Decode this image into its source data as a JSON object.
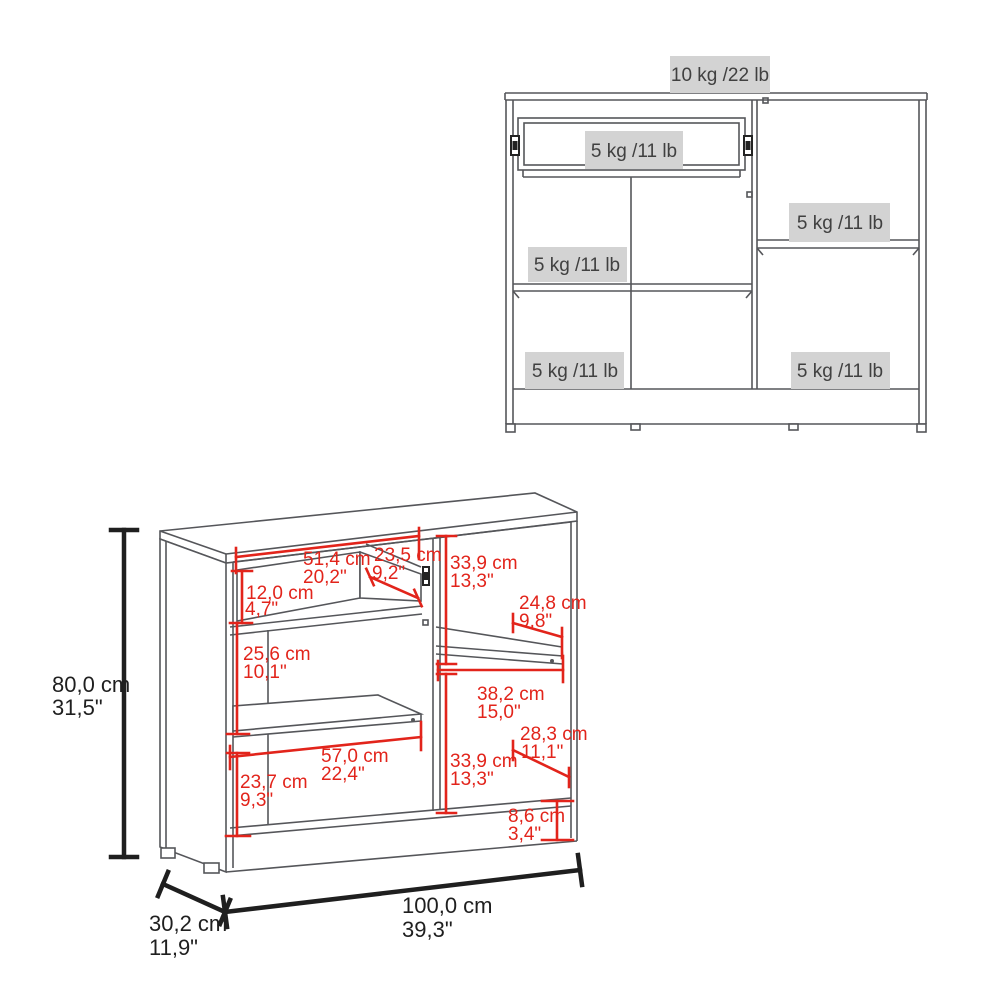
{
  "front_view": {
    "weight_labels": {
      "top": "10 kg /22 lb",
      "drawer": "5 kg /11 lb",
      "left_shelf": "5 kg /11 lb",
      "right_shelf": "5 kg /11 lb",
      "bottom_left": "5 kg /11 lb",
      "bottom_right": "5 kg /11 lb"
    }
  },
  "dimension_view": {
    "height": {
      "cm": "80,0 cm",
      "in": "31,5\""
    },
    "width": {
      "cm": "100,0 cm",
      "in": "39,3\""
    },
    "depth": {
      "cm": "30,2 cm",
      "in": "11,9\""
    },
    "drawer_width": {
      "cm": "51,4 cm",
      "in": "20,2\""
    },
    "drawer_depth": {
      "cm": "23,5 cm",
      "in": "9,2\""
    },
    "drawer_height": {
      "cm": "12,0 cm",
      "in": "4,7\""
    },
    "left_middle_height": {
      "cm": "25,6 cm",
      "in": "10,1\""
    },
    "right_top_height": {
      "cm": "33,9 cm",
      "in": "13,3\""
    },
    "right_shelf_depth": {
      "cm": "24,8 cm",
      "in": "9,8\""
    },
    "right_inner_width": {
      "cm": "38,2 cm",
      "in": "15,0\""
    },
    "left_bottom_width": {
      "cm": "57,0 cm",
      "in": "22,4\""
    },
    "left_bottom_height": {
      "cm": "23,7 cm",
      "in": "9,3\""
    },
    "right_bottom_height": {
      "cm": "33,9 cm",
      "in": "13,3\""
    },
    "right_bottom_depth": {
      "cm": "28,3 cm",
      "in": "11,1\""
    },
    "base_height": {
      "cm": "8,6 cm",
      "in": "3,4\""
    }
  },
  "colors": {
    "dimension_red": "#e2241b",
    "dimension_black": "#1f1f1f",
    "structure_gray": "#55565a",
    "label_background": "#d3d3d3",
    "label_text": "#404040"
  }
}
